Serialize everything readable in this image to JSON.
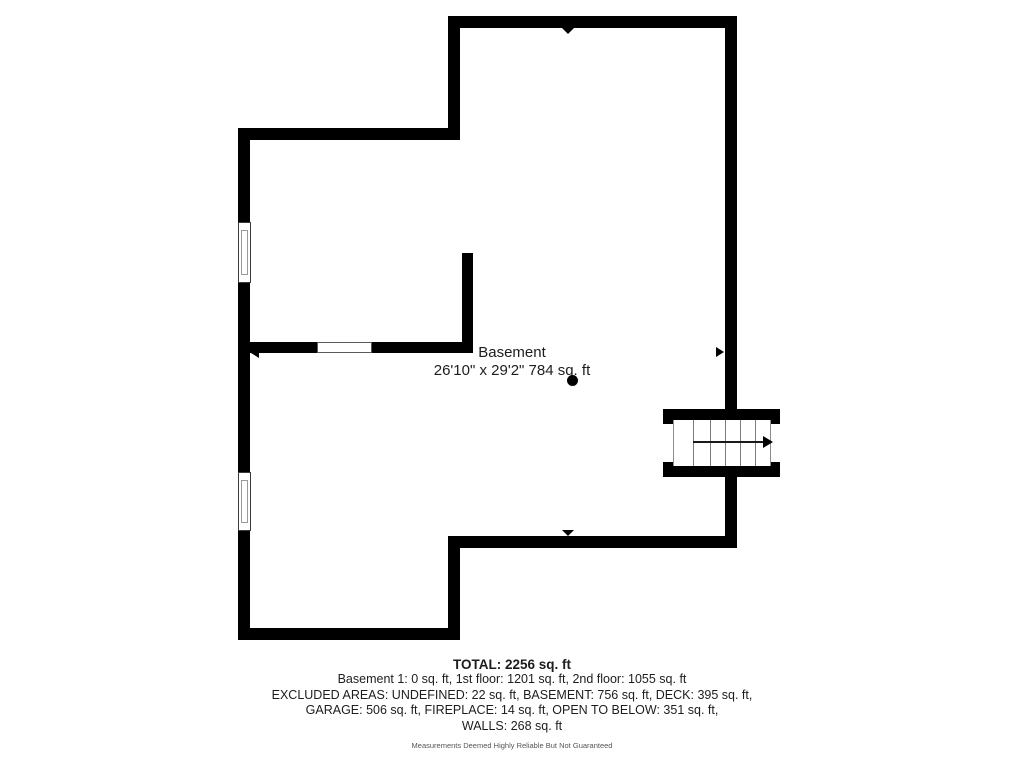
{
  "floorplan": {
    "room": {
      "name": "Basement",
      "dimensions": "26'10\" x 29'2\" 784 sq. ft"
    },
    "summary": {
      "total": "TOTAL: 2256 sq. ft",
      "line1": "Basement 1: 0 sq. ft, 1st floor: 1201 sq. ft, 2nd floor: 1055 sq. ft",
      "line2": "EXCLUDED AREAS: UNDEFINED: 22 sq. ft, BASEMENT: 756 sq. ft, DECK: 395 sq. ft,",
      "line3": "GARAGE: 506 sq. ft, FIREPLACE: 14 sq. ft, OPEN TO BELOW: 351 sq. ft,",
      "line4": "WALLS: 268 sq. ft"
    },
    "disclaimer": "Measurements Deemed Highly Reliable But Not Guaranteed",
    "colors": {
      "wall": "#000000",
      "text": "#1d1d1d",
      "disclaimer_text": "#555555",
      "background": "#ffffff"
    }
  }
}
